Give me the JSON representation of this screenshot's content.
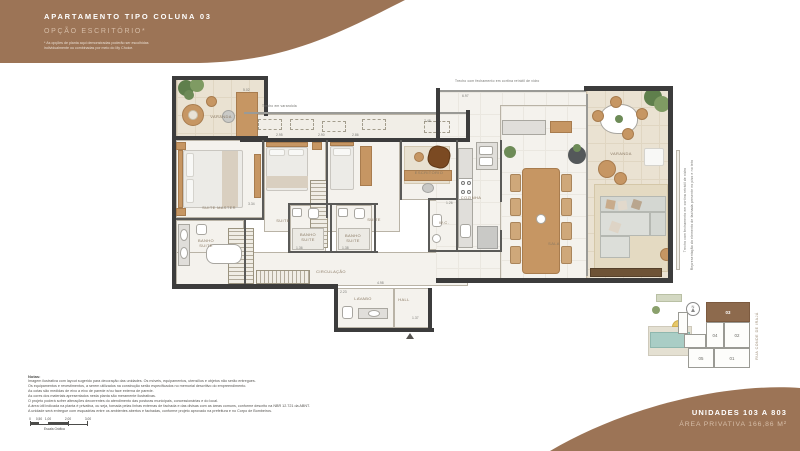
{
  "header": {
    "title": "APARTAMENTO TIPO COLUNA 03",
    "subtitle": "OPÇÃO ESCRITÓRIO*",
    "disclaimer_line1": "* As opções de planta aqui demonstradas poderão ser escolhidas",
    "disclaimer_line2": "individualmente ou combinadas por meio do My Choice."
  },
  "footer_banner": {
    "units": "UNIDADES 103 A 803",
    "area": "ÁREA PRIVATIVA 166,86 M²"
  },
  "plan": {
    "rooms": [
      {
        "id": "varanda-left",
        "label": "VARANDA"
      },
      {
        "id": "suite-master",
        "label": "SUITE MASTER"
      },
      {
        "id": "suite-2",
        "label": "SUITE"
      },
      {
        "id": "suite-3",
        "label": "SUITE"
      },
      {
        "id": "escritorio",
        "label": "ESCRITÓRIO"
      },
      {
        "id": "banho-master",
        "label": "BANHO\nSUITE"
      },
      {
        "id": "banho-suite-a",
        "label": "BANHO\nSUITE"
      },
      {
        "id": "banho-suite-b",
        "label": "BANHO\nSUITE"
      },
      {
        "id": "circulacao",
        "label": "CIRCULAÇÃO"
      },
      {
        "id": "lavabo",
        "label": "LAVABO"
      },
      {
        "id": "hall",
        "label": "HALL"
      },
      {
        "id": "wc",
        "label": "W.C."
      },
      {
        "id": "cozinha",
        "label": "COZINHA"
      },
      {
        "id": "sala",
        "label": "SALA"
      },
      {
        "id": "varanda-right",
        "label": "VARANDA"
      }
    ],
    "annotations": {
      "varandola": "Trecho em varandola",
      "glass_top": "Trecho com fechamento em cortina retrátil de vidro",
      "glass_right": "Trecho com fechamento em cortina retrátil de vidro",
      "facade_right": "Representação do elemento de fachada presente no piso e no teto"
    },
    "dims": [
      {
        "v": "5.02"
      },
      {
        "v": "2.95"
      },
      {
        "v": "2.90"
      },
      {
        "v": "2.86"
      },
      {
        "v": "3.34"
      },
      {
        "v": "6.97"
      },
      {
        "v": "7.48"
      },
      {
        "v": "1.36"
      },
      {
        "v": "1.38"
      },
      {
        "v": "1.26"
      },
      {
        "v": "4.98"
      },
      {
        "v": "2.23"
      },
      {
        "v": "1.37"
      }
    ]
  },
  "notes": {
    "title": "Notas:",
    "lines": [
      "Imagem ilustrativa com layout sugerido para decoração das unidades. Os móveis, equipamentos, utensílios e objetos não serão entregues.",
      "Os equipamentos e revestimentos, a serem utilizados na construção serão especificados no memorial descritivo do empreendimento.",
      "As cotas são medidas de eixo a eixo de parede e/ou face externa de parede.",
      "As cores dos materiais apresentados nesta planta são meramente ilustrativas.",
      "O projeto poderá sofrer alterações decorrentes do atendimento das posturas municipais, concessionárias e do local.",
      "A área útil indicada na planta é privativa, ou seja, tomada pelas linhas externas de fachada e das divisas com as áreas comuns, conforme descrito na NBR 12.721 da ABNT.",
      "A unidade será entregue com esquadrias entre os ambientes abertos e fachadas, conforme projeto aprovado na prefeitura e no Corpo de Bombeiros."
    ]
  },
  "scale_bar": {
    "labels": [
      "0",
      "0,50",
      "1,00",
      "2,00",
      "3,00"
    ],
    "caption": "Escala Gráfica"
  },
  "key_plan": {
    "units": [
      {
        "num": "03",
        "highlight": true
      },
      {
        "num": "04",
        "highlight": false
      },
      {
        "num": "02",
        "highlight": false
      },
      {
        "num": "05",
        "highlight": false
      },
      {
        "num": "01",
        "highlight": false
      }
    ],
    "street": "RUA CONDE DE IRAJÁ",
    "north_label": "N"
  },
  "colors": {
    "banner_brown": "#9c7456",
    "banner_light_text": "#d6bda7",
    "unit_highlight": "#8d6a4d",
    "wall": "#3c3c3c",
    "wood": "#c69663",
    "pool": "#a9cdc5"
  }
}
